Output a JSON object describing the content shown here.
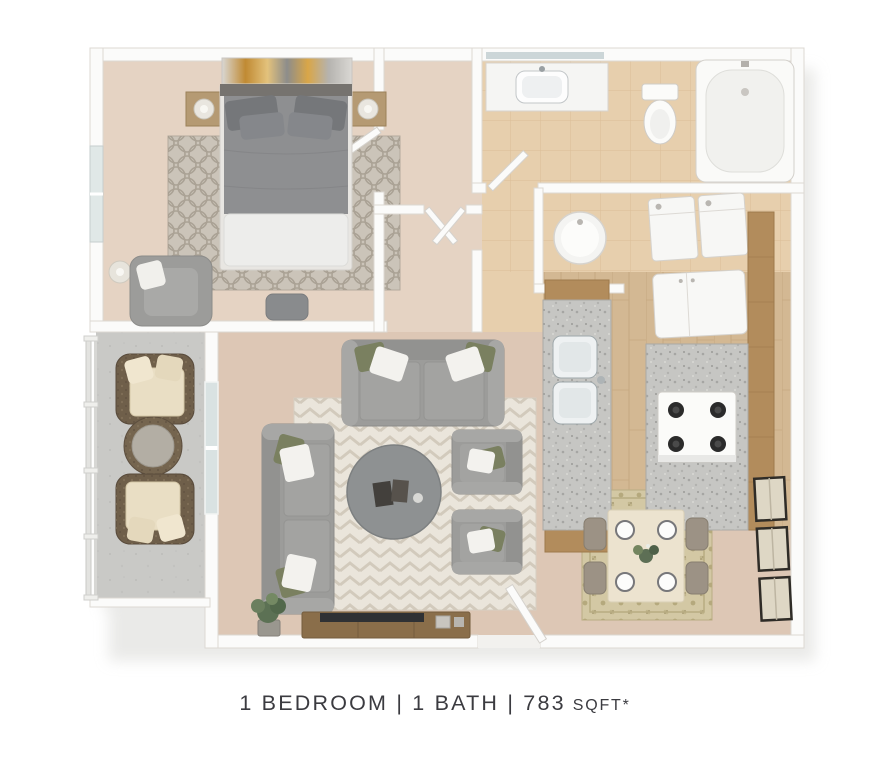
{
  "caption": {
    "main": "1 BEDROOM | 1 BATH | 783",
    "unit": "SQFT*",
    "full": "1 BEDROOM | 1 BATH | 783 SQFT*"
  },
  "floor_plan": {
    "type": "3d-rendered-top-down-apartment-floor-plan",
    "rooms": [
      "bedroom",
      "closet",
      "hallway",
      "bathroom",
      "utility-corridor",
      "kitchen",
      "dining-area",
      "living-room",
      "patio"
    ],
    "furniture": {
      "bedroom": [
        "wall-art",
        "queen-bed",
        "nightstand-left",
        "nightstand-right",
        "table-lamps",
        "trellis-rug",
        "armchair",
        "floor-lamp",
        "ottoman",
        "window"
      ],
      "bathroom": [
        "mirror",
        "vanity-sink",
        "toilet",
        "bathtub"
      ],
      "utility": [
        "water-heater",
        "washer",
        "dryer",
        "refrigerator"
      ],
      "kitchen": [
        "peninsula-counter",
        "double-sink",
        "stove",
        "counter",
        "wood-cabinets"
      ],
      "dining": [
        "dining-table",
        "dining-chairs",
        "place-settings",
        "centerpiece",
        "patterned-rug",
        "triple-wall-art"
      ],
      "living": [
        "loveseat",
        "sofa",
        "armchair-1",
        "armchair-2",
        "round-coffee-table",
        "chevron-rug",
        "tv-console",
        "tv",
        "potted-plant",
        "entry-door"
      ],
      "patio": [
        "railing",
        "wicker-chair-1",
        "wicker-chair-2",
        "wicker-round-table",
        "sliding-glass-door"
      ]
    }
  },
  "colors": {
    "background": "#ffffff",
    "wall": "#fbfbfa",
    "wall_edge": "#dcd8d3",
    "carpet_bedroom": "#e5d3c3",
    "carpet_living": "#ddc7b5",
    "tile_bath": "#e7cfad",
    "wood_floor": "#d3b893",
    "concrete_patio": "#c9c9c6",
    "sofa_gray": "#9c9c9a",
    "pillow_olive": "#7a8060",
    "cabinet_wood": "#b28c5c",
    "granite": "#c6c6c3",
    "caption_text": "#3b3b40"
  }
}
